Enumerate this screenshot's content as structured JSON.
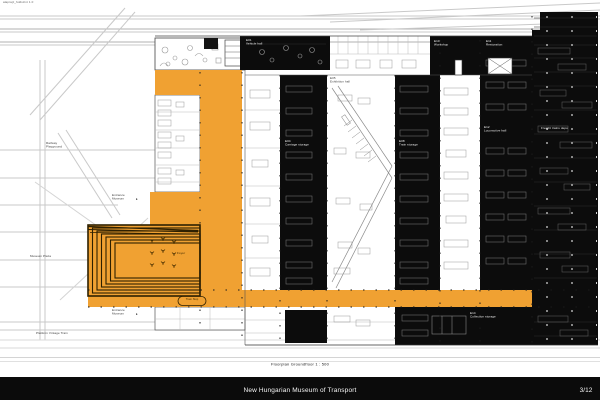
{
  "page": {
    "stamp": "alaprajz_foldszint 1.0",
    "caption": "Floorplan Groundfloor     1 : 500",
    "footer": {
      "title": "New Hungarian Museum of Transport",
      "page": "3/12"
    }
  },
  "colors": {
    "circulation_orange": "#F0A132",
    "poche_black": "#0C0C0C",
    "canopy_line": "#2E2000",
    "context_line": "#C8C8C8"
  },
  "site_labels": {
    "playground": "Railway\nPlayground",
    "entrance_top": "Entrance\nMuseum",
    "entrance_bottom": "Entrance\nMuseum",
    "plaza": "Museum Plaza",
    "platform": "Platform Vintage Train",
    "foyer": "Foyer",
    "tram_stop": "Tram Stop"
  },
  "room_labels": {
    "r1": "E01\nVehicle hall",
    "r2": "E10\nWorkshop",
    "r3": "E11\nRestoration",
    "r4": "E05\nExhibition hall",
    "r5": "E04\nCarriage storage",
    "r6": "E08\nTrain storage",
    "r7": "E12\nLocomotive hall",
    "r8": "Freight trains depo",
    "r9": "E14\nCollection storage"
  }
}
